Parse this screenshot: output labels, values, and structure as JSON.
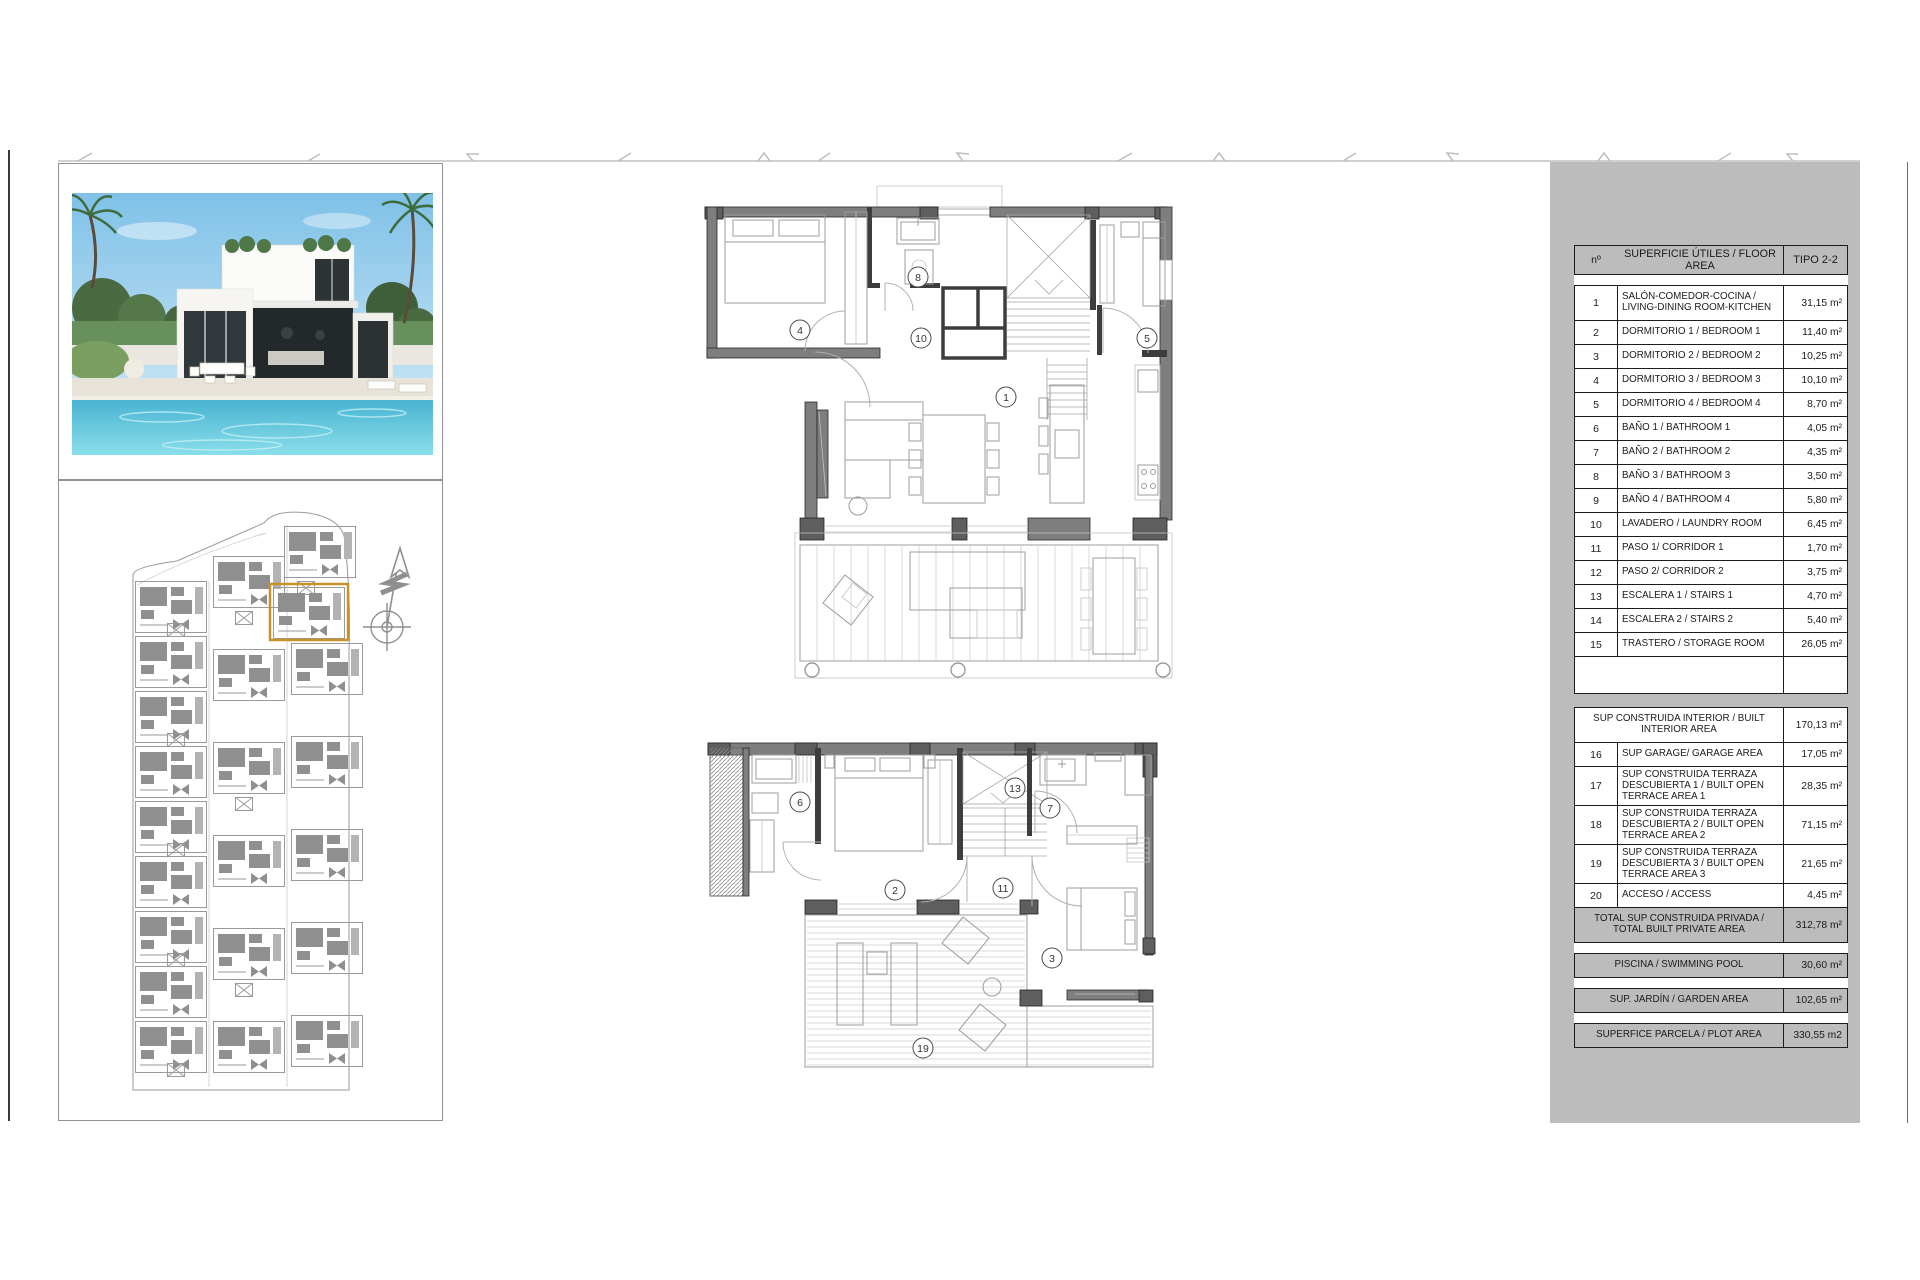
{
  "area_table": {
    "header": {
      "no": "nº",
      "area": "SUPERFICIE ÚTILES / FLOOR AREA",
      "type": "TIPO 2-2"
    },
    "rows": [
      {
        "no": "1",
        "label": "SALÓN-COMEDOR-COCINA / LIVING-DINING ROOM-KITCHEN",
        "value": "31,15 m²"
      },
      {
        "no": "2",
        "label": "DORMITORIO 1 / BEDROOM 1",
        "value": "11,40 m²"
      },
      {
        "no": "3",
        "label": "DORMITORIO 2 / BEDROOM 2",
        "value": "10,25 m²"
      },
      {
        "no": "4",
        "label": "DORMITORIO 3 / BEDROOM 3",
        "value": "10,10 m²"
      },
      {
        "no": "5",
        "label": "DORMITORIO 4 / BEDROOM 4",
        "value": "8,70 m²"
      },
      {
        "no": "6",
        "label": "BAÑO 1 / BATHROOM 1",
        "value": "4,05 m²"
      },
      {
        "no": "7",
        "label": "BAÑO 2 / BATHROOM 2",
        "value": "4,35 m²"
      },
      {
        "no": "8",
        "label": "BAÑO 3 / BATHROOM 3",
        "value": "3,50 m²"
      },
      {
        "no": "9",
        "label": "BAÑO 4 / BATHROOM 4",
        "value": "5,80 m²"
      },
      {
        "no": "10",
        "label": "LAVADERO / LAUNDRY ROOM",
        "value": "6,45 m²"
      },
      {
        "no": "11",
        "label": "PASO 1/ CORRIDOR 1",
        "value": "1,70 m²"
      },
      {
        "no": "12",
        "label": "PASO 2/ CORRIDOR 2",
        "value": "3,75 m²"
      },
      {
        "no": "13",
        "label": "ESCALERA 1 / STAIRS 1",
        "value": "4,70 m²"
      },
      {
        "no": "14",
        "label": "ESCALERA 2 / STAIRS 2",
        "value": "5,40 m²"
      },
      {
        "no": "15",
        "label": "TRASTERO / STORAGE ROOM",
        "value": "26,05 m²"
      }
    ],
    "built_interior": {
      "label": "SUP CONSTRUIDA INTERIOR / BUILT INTERIOR AREA",
      "value": "170,13 m²"
    },
    "rows2": [
      {
        "no": "16",
        "label": "SUP GARAGE/ GARAGE AREA",
        "value": "17,05 m²"
      },
      {
        "no": "17",
        "label": "SUP CONSTRUIDA TERRAZA DESCUBIERTA 1 / BUILT OPEN TERRACE AREA 1",
        "value": "28,35 m²"
      },
      {
        "no": "18",
        "label": "SUP CONSTRUIDA TERRAZA DESCUBIERTA 2 / BUILT OPEN TERRACE AREA 2",
        "value": "71,15 m²"
      },
      {
        "no": "19",
        "label": "SUP CONSTRUIDA TERRAZA DESCUBIERTA 3 / BUILT OPEN TERRACE AREA 3",
        "value": "21,65 m²"
      },
      {
        "no": "20",
        "label": "ACCESO / ACCESS",
        "value": "4,45 m²"
      }
    ],
    "total": {
      "label": "TOTAL SUP CONSTRUIDA PRIVADA / TOTAL BUILT PRIVATE AREA",
      "value": "312,78 m²"
    },
    "summary": [
      {
        "label": "PISCINA / SWIMMING POOL",
        "value": "30,60 m²"
      },
      {
        "label": "SUP. JARDÍN / GARDEN AREA",
        "value": "102,65 m²"
      },
      {
        "label": "SUPERFICE PARCELA / PLOT AREA",
        "value": "330,55 m2"
      }
    ]
  },
  "plans": {
    "upper_labels": [
      "4",
      "8",
      "10",
      "5",
      "1"
    ],
    "lower_labels": [
      "6",
      "2",
      "13",
      "7",
      "11",
      "3",
      "19"
    ]
  },
  "colors": {
    "highlight": "#c8922b",
    "panel": "#bcbcbc"
  }
}
